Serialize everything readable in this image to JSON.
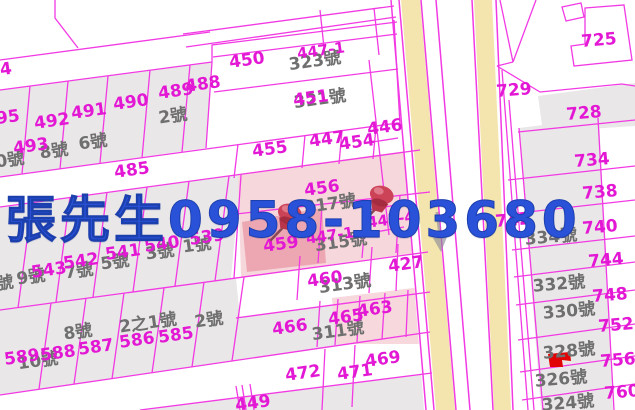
{
  "overlay": {
    "contact_text": "張先生0958-103680",
    "color": "#2a52d8"
  },
  "map": {
    "colors": {
      "parcel_line": "#f23ae4",
      "parcel_number_text": "#e318d4",
      "house_number_text": "#6f6f6f",
      "parcel_fill_gray": "#eae7e8",
      "road_yellow": "#f3e5ad",
      "highlight_pink_light": "#f6d7db",
      "highlight_pink_strong": "#eda7b3",
      "pushpin_red": "#cc4257",
      "landmark_red": "#e10404"
    },
    "parcel_numbers": [
      {
        "t": "4",
        "x": 6,
        "y": 70
      },
      {
        "t": "95",
        "x": 8,
        "y": 118
      },
      {
        "t": "492",
        "x": 52,
        "y": 122
      },
      {
        "t": "491",
        "x": 89,
        "y": 112
      },
      {
        "t": "490",
        "x": 131,
        "y": 103
      },
      {
        "t": "489",
        "x": 176,
        "y": 92
      },
      {
        "t": "488",
        "x": 203,
        "y": 85
      },
      {
        "t": "493",
        "x": 31,
        "y": 147
      },
      {
        "t": "450",
        "x": 247,
        "y": 61
      },
      {
        "t": "447-1",
        "x": 321,
        "y": 51,
        "s": 15
      },
      {
        "t": "451",
        "x": 311,
        "y": 99
      },
      {
        "t": "446",
        "x": 385,
        "y": 128
      },
      {
        "t": "455",
        "x": 270,
        "y": 150
      },
      {
        "t": "447",
        "x": 327,
        "y": 140
      },
      {
        "t": "454",
        "x": 357,
        "y": 143
      },
      {
        "t": "485",
        "x": 132,
        "y": 171
      },
      {
        "t": "456",
        "x": 322,
        "y": 189
      },
      {
        "t": "445-4",
        "x": 391,
        "y": 220,
        "s": 15
      },
      {
        "t": "459",
        "x": 281,
        "y": 245
      },
      {
        "t": "447-1",
        "x": 330,
        "y": 236,
        "s": 15
      },
      {
        "t": "427",
        "x": 406,
        "y": 265
      },
      {
        "t": "460",
        "x": 325,
        "y": 280
      },
      {
        "t": "539",
        "x": 207,
        "y": 238
      },
      {
        "t": "540",
        "x": 162,
        "y": 245
      },
      {
        "t": "541",
        "x": 123,
        "y": 253
      },
      {
        "t": "542",
        "x": 81,
        "y": 262
      },
      {
        "t": "543",
        "x": 49,
        "y": 271
      },
      {
        "t": "463",
        "x": 375,
        "y": 310
      },
      {
        "t": "465",
        "x": 346,
        "y": 318
      },
      {
        "t": "466",
        "x": 290,
        "y": 328
      },
      {
        "t": "472",
        "x": 303,
        "y": 374
      },
      {
        "t": "471",
        "x": 355,
        "y": 373
      },
      {
        "t": "469",
        "x": 383,
        "y": 360
      },
      {
        "t": "449",
        "x": 253,
        "y": 404
      },
      {
        "t": "589",
        "x": 22,
        "y": 358
      },
      {
        "t": "588",
        "x": 58,
        "y": 354
      },
      {
        "t": "587",
        "x": 96,
        "y": 348
      },
      {
        "t": "586",
        "x": 137,
        "y": 341
      },
      {
        "t": "585",
        "x": 176,
        "y": 336
      },
      {
        "t": "725",
        "x": 599,
        "y": 41,
        "r": -5
      },
      {
        "t": "729",
        "x": 514,
        "y": 91,
        "r": -5
      },
      {
        "t": "728",
        "x": 584,
        "y": 114,
        "r": -5
      },
      {
        "t": "734",
        "x": 592,
        "y": 161,
        "r": -5
      },
      {
        "t": "738",
        "x": 600,
        "y": 193,
        "r": -5
      },
      {
        "t": "742",
        "x": 513,
        "y": 221,
        "r": -5
      },
      {
        "t": "740",
        "x": 600,
        "y": 228,
        "r": -5
      },
      {
        "t": "744",
        "x": 606,
        "y": 261,
        "r": -5
      },
      {
        "t": "748",
        "x": 610,
        "y": 296,
        "r": -5
      },
      {
        "t": "752",
        "x": 616,
        "y": 326,
        "r": -5
      },
      {
        "t": "756",
        "x": 618,
        "y": 361,
        "r": -5
      },
      {
        "t": "760",
        "x": 622,
        "y": 393,
        "r": -5
      }
    ],
    "house_numbers": [
      {
        "t": "2號",
        "x": 173,
        "y": 117
      },
      {
        "t": "6號",
        "x": 93,
        "y": 143
      },
      {
        "t": "8號",
        "x": 54,
        "y": 152
      },
      {
        "t": "0號",
        "x": 10,
        "y": 161
      },
      {
        "t": "323號",
        "x": 315,
        "y": 62
      },
      {
        "t": "321號",
        "x": 320,
        "y": 100
      },
      {
        "t": "317號",
        "x": 330,
        "y": 205
      },
      {
        "t": "315號",
        "x": 341,
        "y": 243
      },
      {
        "t": "313號",
        "x": 345,
        "y": 285
      },
      {
        "t": "311號",
        "x": 338,
        "y": 332
      },
      {
        "t": "9號",
        "x": 31,
        "y": 278
      },
      {
        "t": "7號",
        "x": 79,
        "y": 272
      },
      {
        "t": "5號",
        "x": 115,
        "y": 263
      },
      {
        "t": "3號",
        "x": 160,
        "y": 253
      },
      {
        "t": "1號",
        "x": 197,
        "y": 246
      },
      {
        "t": "號",
        "x": 5,
        "y": 284
      },
      {
        "t": "10號",
        "x": 38,
        "y": 362
      },
      {
        "t": "8號",
        "x": 78,
        "y": 333
      },
      {
        "t": "2之1號",
        "x": 148,
        "y": 324
      },
      {
        "t": "2號",
        "x": 209,
        "y": 321
      },
      {
        "t": "334號",
        "x": 551,
        "y": 238,
        "r": -5
      },
      {
        "t": "332號",
        "x": 559,
        "y": 285,
        "r": -5
      },
      {
        "t": "330號",
        "x": 569,
        "y": 312,
        "r": -5
      },
      {
        "t": "328號",
        "x": 569,
        "y": 352,
        "r": -5
      },
      {
        "t": "326號",
        "x": 561,
        "y": 380,
        "r": -5
      },
      {
        "t": "324號",
        "x": 568,
        "y": 404,
        "r": -5
      }
    ],
    "pins": [
      {
        "x": 287,
        "y": 225
      },
      {
        "x": 379,
        "y": 207
      }
    ]
  }
}
